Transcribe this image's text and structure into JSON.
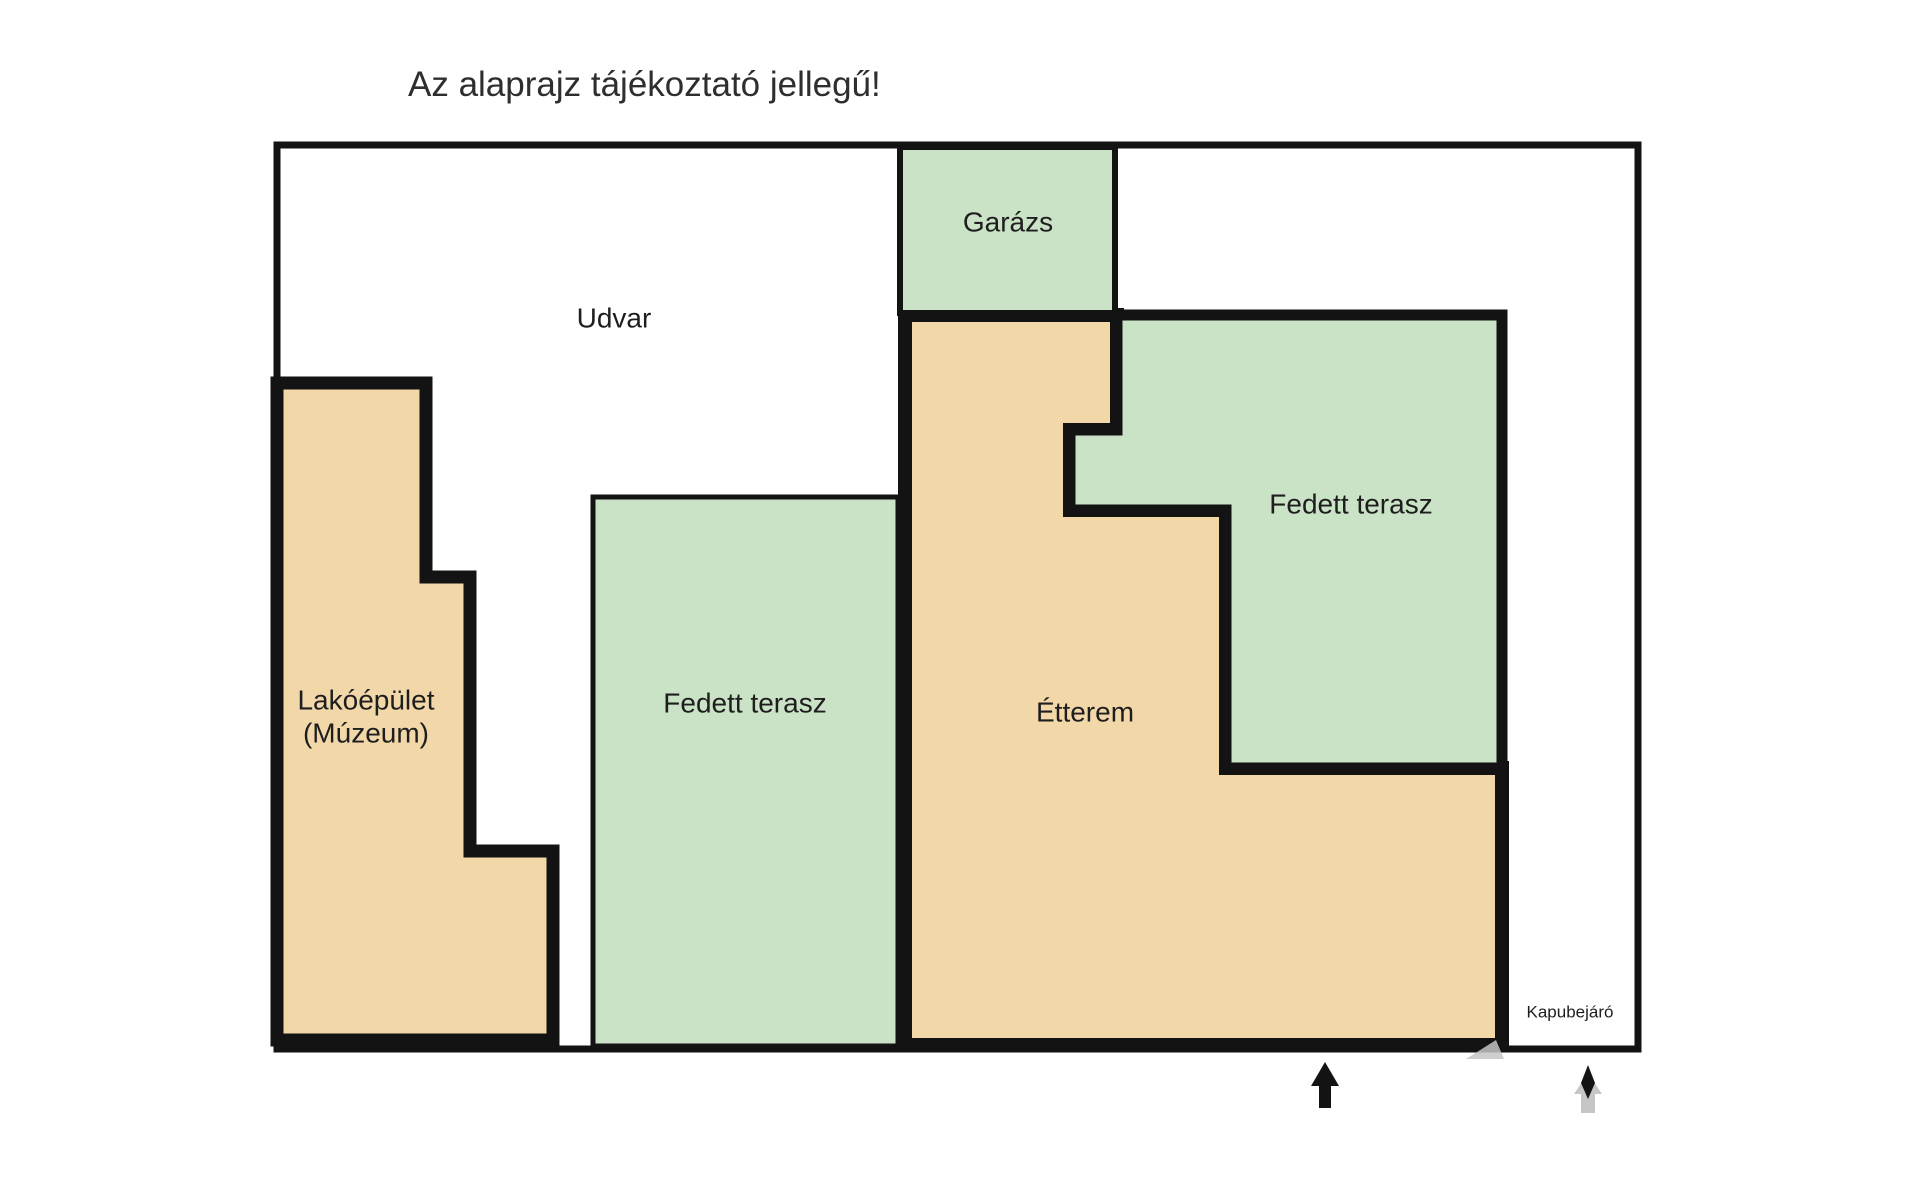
{
  "title": "Az alaprajz tájékoztató jellegű!",
  "colors": {
    "page_bg": "#ffffff",
    "room_tan": "#f2d7a9",
    "room_green": "#cae2c5",
    "outline": "#131313",
    "label_text": "#1e1e1e",
    "title_text": "#2e2e2e",
    "gray_accent": "#c6c6c6"
  },
  "rooms": {
    "udvar": {
      "label": "Udvar"
    },
    "garazs": {
      "label": "Garázs"
    },
    "lakoepulet": {
      "line1": "Lakóépület",
      "line2": "(Múzeum)"
    },
    "fedett_terasz_left": {
      "label": "Fedett terasz"
    },
    "fedett_terasz_right": {
      "label": "Fedett terasz"
    },
    "etterem": {
      "label": "Étterem"
    },
    "kapubejaro": {
      "label": "Kapubejáró"
    }
  },
  "icons": {
    "entrance_arrow": "black-up-arrow",
    "gate_arrow": "gray-up-arrow-with-black-diamond"
  }
}
